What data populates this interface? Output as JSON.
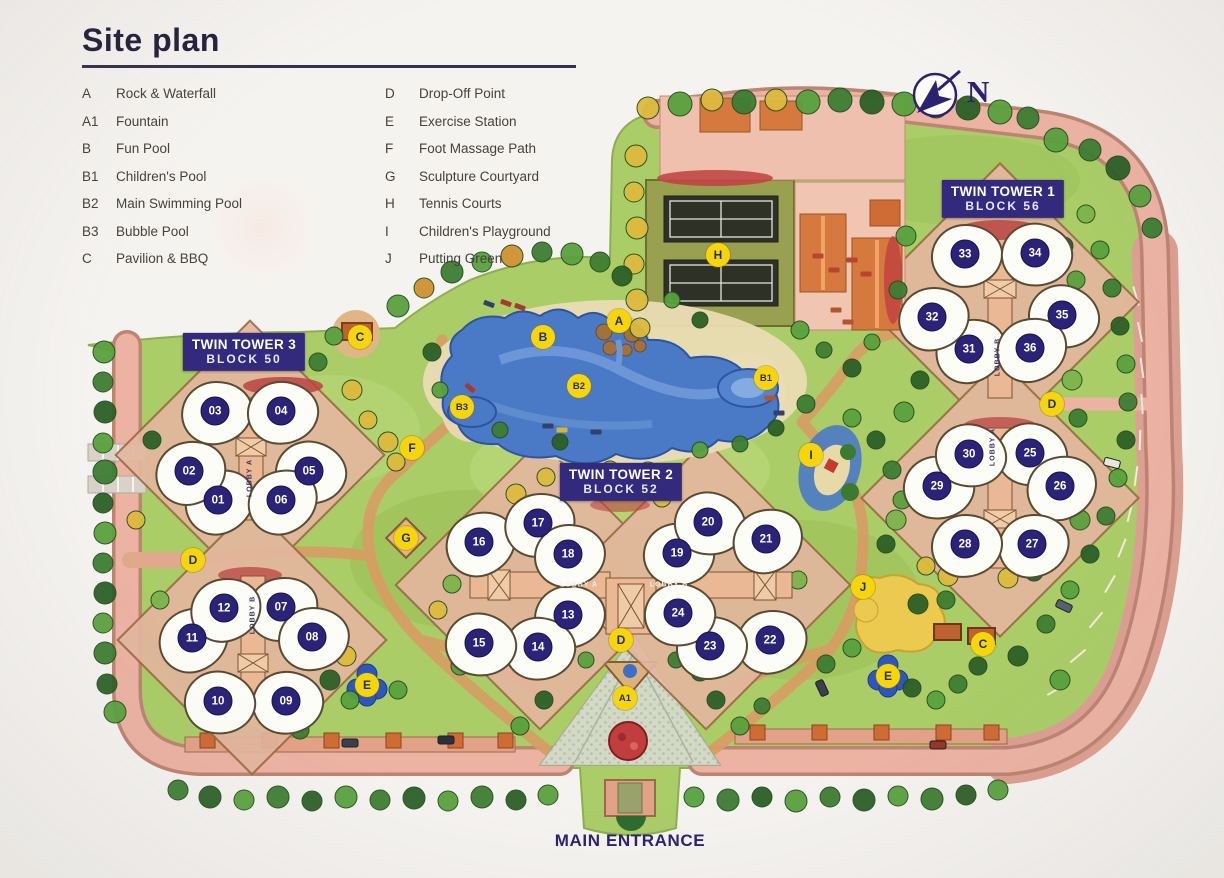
{
  "title": "Site plan",
  "north_label": "N",
  "main_entrance_label": "MAIN ENTRANCE",
  "legend": {
    "col1": [
      {
        "code": "A",
        "label": "Rock & Waterfall"
      },
      {
        "code": "A1",
        "label": "Fountain"
      },
      {
        "code": "B",
        "label": "Fun Pool"
      },
      {
        "code": "B1",
        "label": "Children's Pool"
      },
      {
        "code": "B2",
        "label": "Main Swimming Pool"
      },
      {
        "code": "B3",
        "label": "Bubble Pool"
      },
      {
        "code": "C",
        "label": "Pavilion & BBQ"
      }
    ],
    "col2": [
      {
        "code": "D",
        "label": "Drop-Off Point"
      },
      {
        "code": "E",
        "label": "Exercise Station"
      },
      {
        "code": "F",
        "label": "Foot Massage Path"
      },
      {
        "code": "G",
        "label": "Sculpture Courtyard"
      },
      {
        "code": "H",
        "label": "Tennis Courts"
      },
      {
        "code": "I",
        "label": "Children's Playground"
      },
      {
        "code": "J",
        "label": "Putting Green"
      }
    ]
  },
  "towers": [
    {
      "line1": "TWIN TOWER 3",
      "line2": "BLOCK 50",
      "x": 244,
      "y": 352
    },
    {
      "line1": "TWIN TOWER 2",
      "line2": "BLOCK 52",
      "x": 621,
      "y": 482
    },
    {
      "line1": "TWIN TOWER 1",
      "line2": "BLOCK 56",
      "x": 1003,
      "y": 199
    }
  ],
  "lobbies": [
    {
      "text": "LOBBY A",
      "x": 250,
      "y": 478,
      "vertical": true
    },
    {
      "text": "LOBBY B",
      "x": 253,
      "y": 615,
      "vertical": true
    },
    {
      "text": "LOBBY A",
      "x": 579,
      "y": 585,
      "vertical": false
    },
    {
      "text": "LOBBY B",
      "x": 669,
      "y": 585,
      "vertical": false
    },
    {
      "text": "LOBBY B",
      "x": 998,
      "y": 357,
      "vertical": true
    },
    {
      "text": "LOBBY A",
      "x": 993,
      "y": 447,
      "vertical": true
    }
  ],
  "units": [
    {
      "num": "01",
      "x": 218,
      "y": 500
    },
    {
      "num": "02",
      "x": 189,
      "y": 471
    },
    {
      "num": "03",
      "x": 215,
      "y": 411
    },
    {
      "num": "04",
      "x": 281,
      "y": 411
    },
    {
      "num": "05",
      "x": 309,
      "y": 471
    },
    {
      "num": "06",
      "x": 281,
      "y": 500
    },
    {
      "num": "07",
      "x": 281,
      "y": 607
    },
    {
      "num": "08",
      "x": 312,
      "y": 637
    },
    {
      "num": "09",
      "x": 286,
      "y": 701
    },
    {
      "num": "10",
      "x": 218,
      "y": 701
    },
    {
      "num": "11",
      "x": 192,
      "y": 638
    },
    {
      "num": "12",
      "x": 224,
      "y": 608
    },
    {
      "num": "13",
      "x": 568,
      "y": 615
    },
    {
      "num": "14",
      "x": 538,
      "y": 647
    },
    {
      "num": "15",
      "x": 479,
      "y": 643
    },
    {
      "num": "16",
      "x": 479,
      "y": 542
    },
    {
      "num": "17",
      "x": 538,
      "y": 523
    },
    {
      "num": "18",
      "x": 568,
      "y": 554
    },
    {
      "num": "19",
      "x": 677,
      "y": 553
    },
    {
      "num": "20",
      "x": 708,
      "y": 522
    },
    {
      "num": "21",
      "x": 766,
      "y": 539
    },
    {
      "num": "22",
      "x": 770,
      "y": 640
    },
    {
      "num": "23",
      "x": 710,
      "y": 646
    },
    {
      "num": "24",
      "x": 678,
      "y": 613
    },
    {
      "num": "25",
      "x": 1030,
      "y": 453
    },
    {
      "num": "26",
      "x": 1060,
      "y": 486
    },
    {
      "num": "27",
      "x": 1032,
      "y": 544
    },
    {
      "num": "28",
      "x": 965,
      "y": 544
    },
    {
      "num": "29",
      "x": 937,
      "y": 486
    },
    {
      "num": "30",
      "x": 969,
      "y": 454
    },
    {
      "num": "31",
      "x": 969,
      "y": 349
    },
    {
      "num": "32",
      "x": 932,
      "y": 317
    },
    {
      "num": "33",
      "x": 965,
      "y": 254
    },
    {
      "num": "34",
      "x": 1035,
      "y": 253
    },
    {
      "num": "35",
      "x": 1062,
      "y": 315
    },
    {
      "num": "36",
      "x": 1030,
      "y": 348
    }
  ],
  "amenity_markers": [
    {
      "code": "A",
      "x": 619,
      "y": 321
    },
    {
      "code": "A1",
      "x": 625,
      "y": 698
    },
    {
      "code": "B",
      "x": 543,
      "y": 337
    },
    {
      "code": "B1",
      "x": 766,
      "y": 378
    },
    {
      "code": "B2",
      "x": 579,
      "y": 386
    },
    {
      "code": "B3",
      "x": 462,
      "y": 407
    },
    {
      "code": "C",
      "x": 360,
      "y": 337
    },
    {
      "code": "C",
      "x": 983,
      "y": 644
    },
    {
      "code": "D",
      "x": 193,
      "y": 560
    },
    {
      "code": "D",
      "x": 621,
      "y": 640
    },
    {
      "code": "D",
      "x": 1052,
      "y": 404
    },
    {
      "code": "E",
      "x": 367,
      "y": 685
    },
    {
      "code": "E",
      "x": 888,
      "y": 676
    },
    {
      "code": "F",
      "x": 412,
      "y": 448
    },
    {
      "code": "G",
      "x": 406,
      "y": 538
    },
    {
      "code": "H",
      "x": 718,
      "y": 255
    },
    {
      "code": "I",
      "x": 811,
      "y": 455
    },
    {
      "code": "J",
      "x": 863,
      "y": 587
    }
  ],
  "colors": {
    "navy": "#2b2377",
    "tower_label_bg": "#332a7e",
    "marker_yellow": "#f6d60a",
    "lawn_green": "#aacd68",
    "road_salmon": "#e7ab9c",
    "pool_blue": "#4a7ac6"
  }
}
